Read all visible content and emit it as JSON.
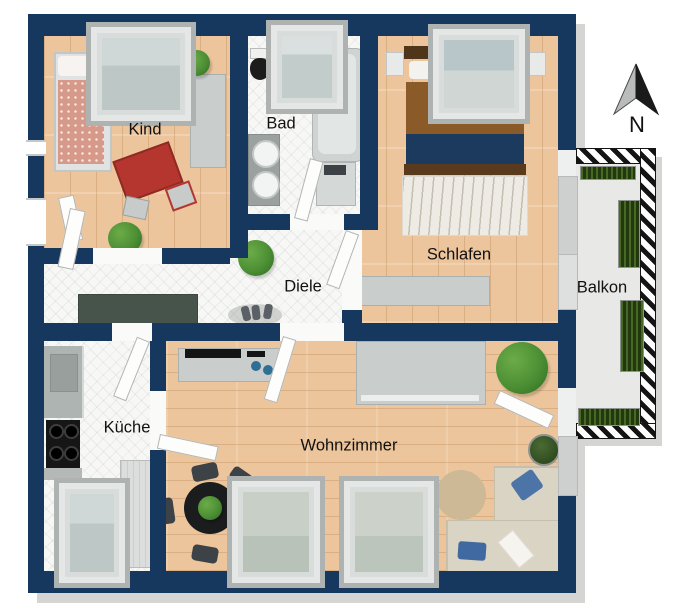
{
  "plan_title": "apartment-floor-plan",
  "compass": {
    "label": "N"
  },
  "colors": {
    "wall": "#16375e",
    "shadow": "#d5d5d3",
    "wood": "#ecc59c",
    "tile": "#f7f7f6",
    "balcony": "#e8e8e6",
    "red": "#b5362e",
    "blue": "#4d74a6",
    "plant": "#4c8f34",
    "window_frame": "#aeb3b2",
    "sofa": "#dad4c4",
    "dark_sideboard": "#47544b"
  },
  "rooms": [
    {
      "id": "kind",
      "label": "Kind",
      "furniture": [
        "single-bed",
        "window",
        "wardrobe",
        "red-table",
        "red-chair",
        "stool",
        "plant",
        "plant"
      ]
    },
    {
      "id": "bad",
      "label": "Bad",
      "furniture": [
        "shower",
        "toilet",
        "double-washbasin",
        "bathtub",
        "washing-machine"
      ]
    },
    {
      "id": "schlafen",
      "label": "Schlafen",
      "furniture": [
        "double-bed",
        "nightstand",
        "nightstand",
        "window",
        "wavy-rug",
        "dresser",
        "balcony-door"
      ]
    },
    {
      "id": "diele",
      "label": "Diele",
      "furniture": [
        "dark-sideboard",
        "plant",
        "shoes",
        "entrance-door"
      ]
    },
    {
      "id": "kueche",
      "label": "Küche",
      "furniture": [
        "counter",
        "stove",
        "tall-cabinet",
        "window",
        "door"
      ]
    },
    {
      "id": "wohnzimmer",
      "label": "Wohnzimmer",
      "furniture": [
        "sideboard",
        "desk",
        "dining-table",
        "dining-chairs",
        "round-rug",
        "corner-sofa",
        "blue-pillows",
        "white-throw",
        "plant",
        "plant",
        "window",
        "window",
        "balcony-door"
      ]
    },
    {
      "id": "balkon",
      "label": "Balkon",
      "furniture": [
        "railing",
        "planter",
        "planter",
        "planter",
        "grass-strip"
      ]
    }
  ]
}
